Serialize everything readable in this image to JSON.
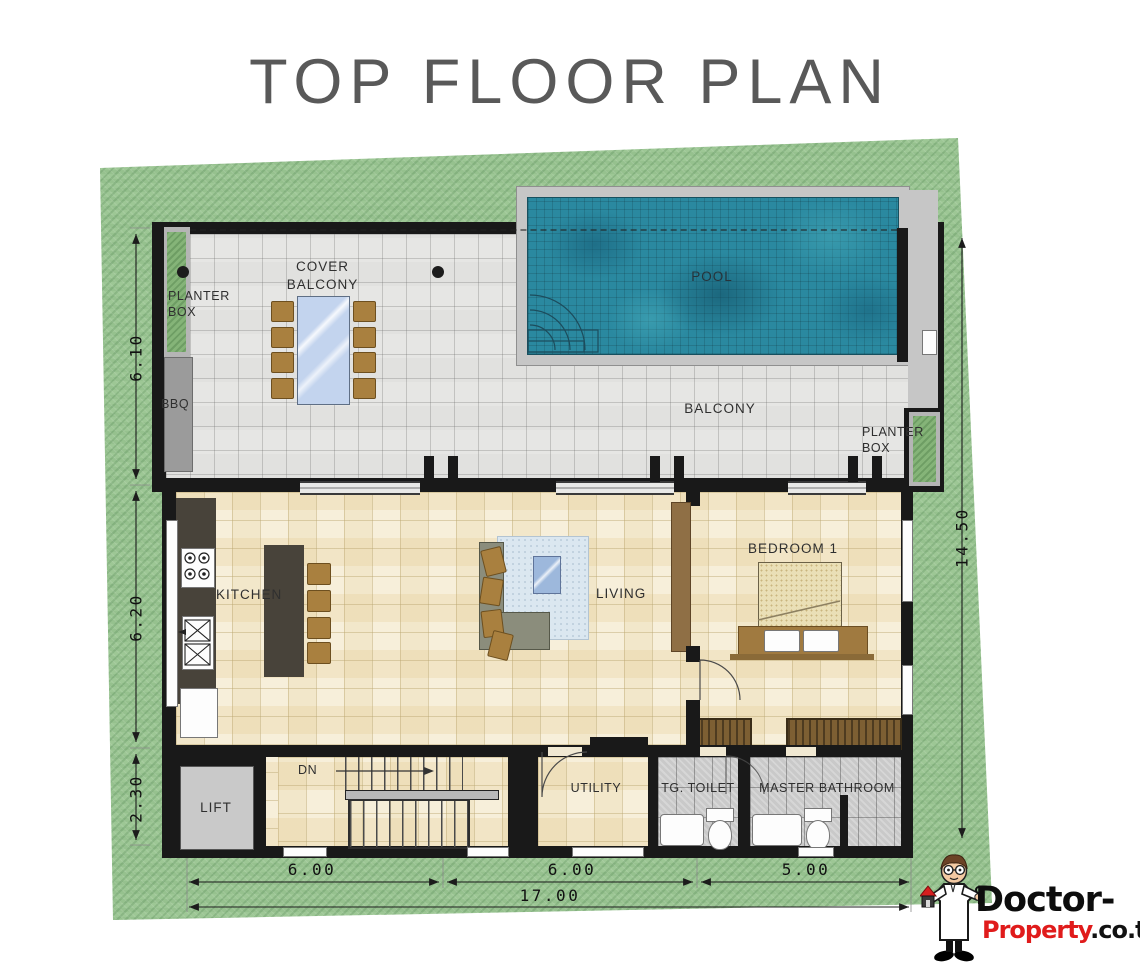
{
  "title": "TOP FLOOR PLAN",
  "plan": {
    "labels": {
      "planter_box_left": "PLANTER\nBOX",
      "bbq": "BBQ",
      "cover_balcony": "COVER\nBALCONY",
      "pool": "POOL",
      "balcony": "BALCONY",
      "planter_box_right": "PLANTER\nBOX",
      "kitchen": "KITCHEN",
      "living": "LIVING",
      "bedroom_1": "BEDROOM 1",
      "lift": "LIFT",
      "stairs_down": "DN",
      "utility": "UTILITY",
      "tg_toilet": "TG. TOILET",
      "master_bathroom": "MASTER BATHROOM"
    },
    "dimensions": {
      "left_top": "6.10",
      "left_middle": "6.20",
      "left_bottom": "2.30",
      "right_side": "14.50",
      "bottom_left": "6.00",
      "bottom_middle": "6.00",
      "bottom_right": "5.00",
      "bottom_total": "17.00"
    }
  },
  "watermark": {
    "brand_primary": "Doctor-",
    "brand_secondary": "Property",
    "brand_domain": ".co.th"
  },
  "colors": {
    "grass": "#9dc795",
    "pool_water": "#2a89a0",
    "wall": "#191919",
    "interior_floor": "#f7efda",
    "balcony_tile": "#e6e6e4",
    "bathroom_tile": "#c9c9c9",
    "brand_red": "#e01b1b"
  }
}
